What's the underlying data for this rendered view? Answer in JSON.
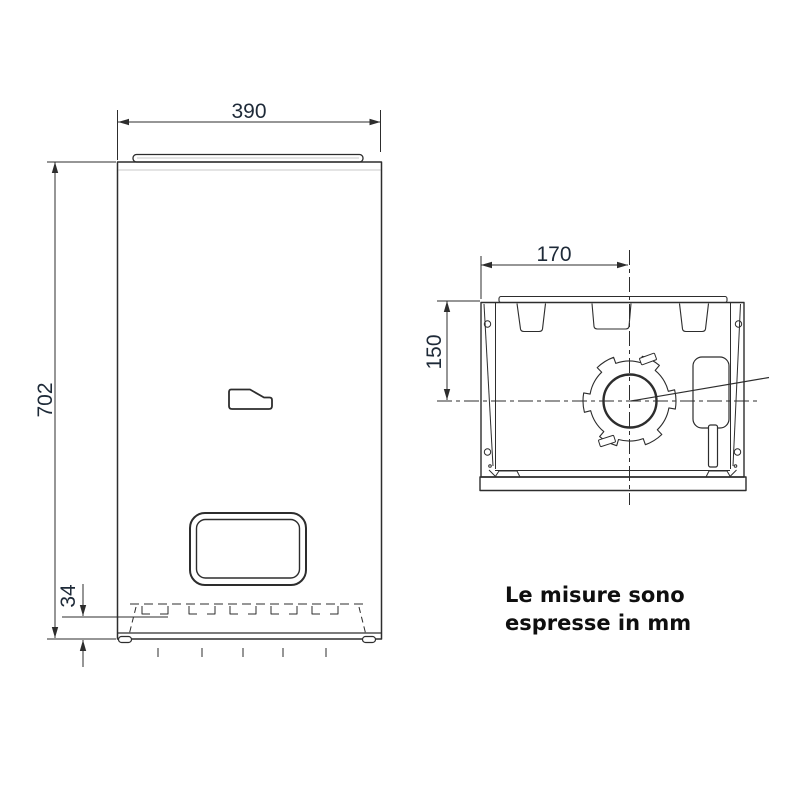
{
  "drawing": {
    "dimensions": {
      "front_width_mm": "390",
      "front_height_mm": "702",
      "bottom_clearance_mm": "34",
      "flue_offset_x_mm": "170",
      "flue_offset_y_mm": "150"
    },
    "note": {
      "line1": "Le misure sono",
      "line2": "espresse in mm"
    }
  },
  "colors": {
    "line": "#2d2d2d",
    "dim-text": "#1e2a38",
    "note-text": "#0f0f0f",
    "background": "#ffffff"
  }
}
